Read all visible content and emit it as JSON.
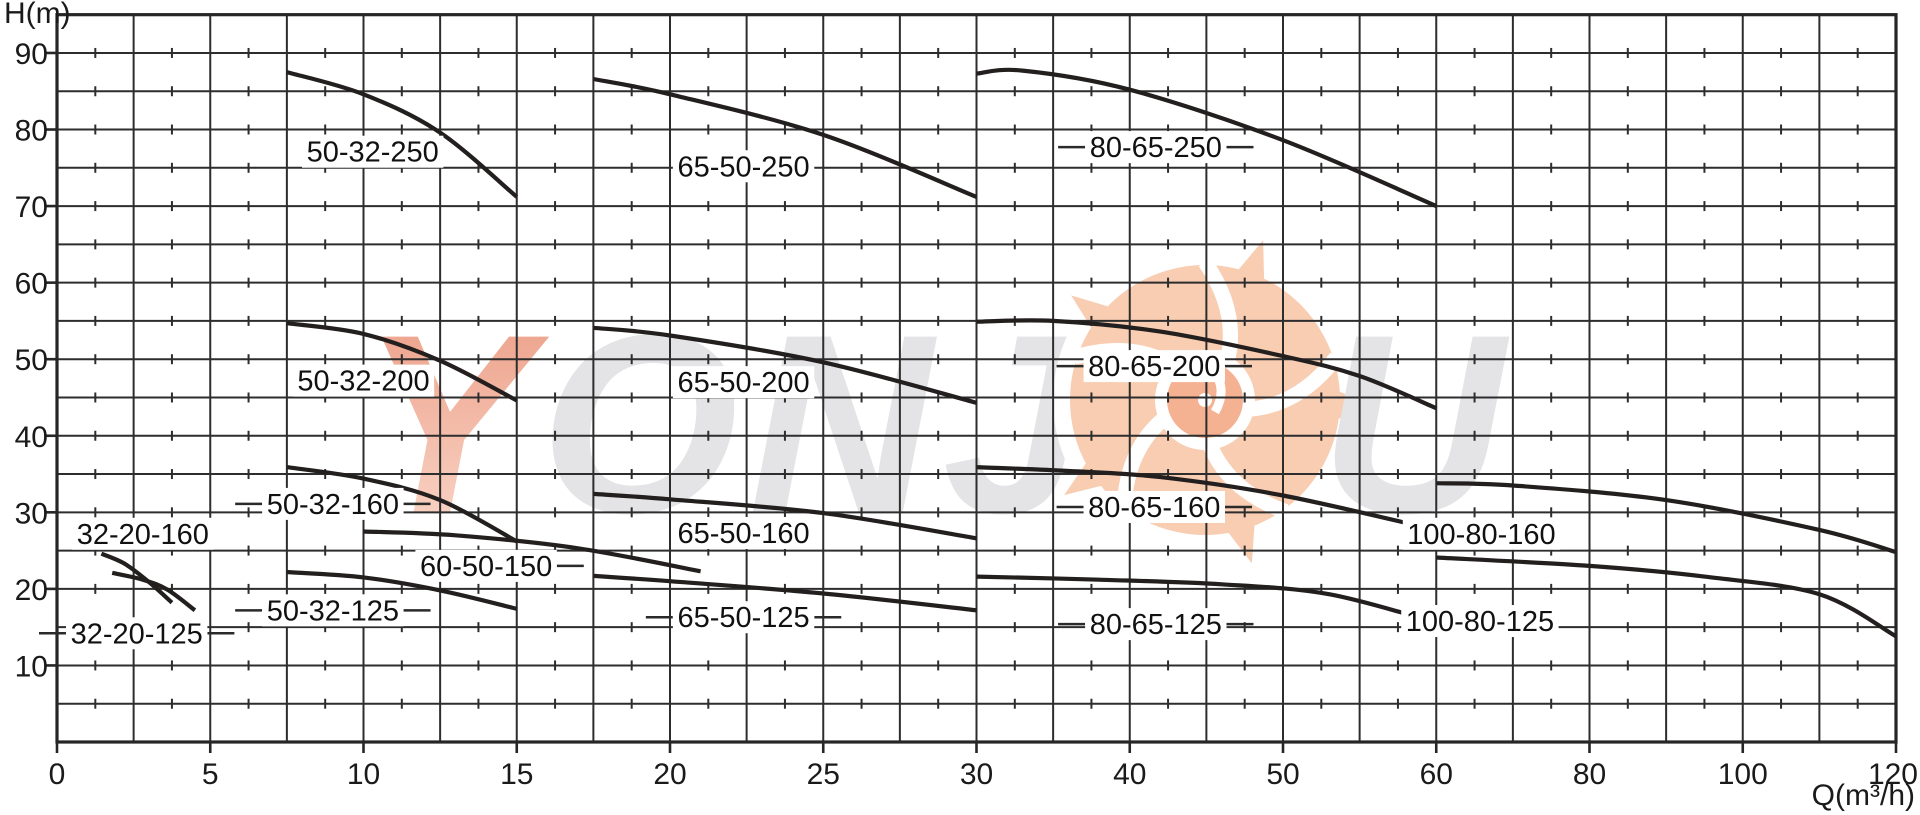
{
  "axes": {
    "y_title": "H(m)",
    "x_title": "Q(m³/h)"
  },
  "watermark": {
    "text_left": "YONJ",
    "text_right": "OU",
    "letter_color": "#e4e4e6",
    "first_letter_top": "#eb9a82",
    "first_letter_bottom": "#fbdccf",
    "flower_petal": "#f8cdb2",
    "flower_inner": "#f5b293"
  },
  "chart_data": {
    "type": "line",
    "title": "",
    "xlabel": "Q(m³/h)",
    "ylabel": "H(m)",
    "x_ticks": [
      0,
      5,
      10,
      15,
      20,
      25,
      30,
      40,
      50,
      60,
      80,
      100,
      120
    ],
    "y_tick_labels": [
      10,
      20,
      30,
      40,
      50,
      60,
      70,
      80,
      90
    ],
    "y_min": 0,
    "y_max": 95,
    "y_grid_step": 5,
    "grid": true,
    "grid_color": "#2d2d2d",
    "curve_color": "#241f1f",
    "label_text_color": "#111111",
    "series": [
      {
        "name": "32-20-160",
        "points": [
          [
            1.45,
            24.6
          ],
          [
            2.2,
            23.3
          ],
          [
            3.0,
            20.9
          ],
          [
            3.75,
            18.2
          ]
        ],
        "label_q": 2.8,
        "label_h": 27.2,
        "leaders": "none"
      },
      {
        "name": "32-20-125",
        "points": [
          [
            1.8,
            22.1
          ],
          [
            2.8,
            21.2
          ],
          [
            3.6,
            19.9
          ],
          [
            4.5,
            17.2
          ]
        ],
        "label_q": 2.6,
        "label_h": 14.2,
        "leaders": "both"
      },
      {
        "name": "50-32-250",
        "points": [
          [
            7.5,
            87.5
          ],
          [
            10,
            84.6
          ],
          [
            12.5,
            79.6
          ],
          [
            15,
            71.2
          ]
        ],
        "label_q": 10.3,
        "label_h": 77.1,
        "leaders": "none"
      },
      {
        "name": "50-32-200",
        "points": [
          [
            7.5,
            54.7
          ],
          [
            10,
            53.3
          ],
          [
            12.5,
            49.8
          ],
          [
            15,
            44.6
          ]
        ],
        "label_q": 10.0,
        "label_h": 47.2,
        "leaders": "none"
      },
      {
        "name": "50-32-160",
        "points": [
          [
            7.5,
            35.9
          ],
          [
            10,
            34.4
          ],
          [
            12.5,
            31.6
          ],
          [
            15,
            26.2
          ]
        ],
        "label_q": 9.0,
        "label_h": 31.1,
        "leaders": "both"
      },
      {
        "name": "50-32-125",
        "points": [
          [
            7.5,
            22.2
          ],
          [
            10,
            21.5
          ],
          [
            12.5,
            19.8
          ],
          [
            15,
            17.4
          ]
        ],
        "label_q": 9.0,
        "label_h": 17.2,
        "leaders": "both"
      },
      {
        "name": "60-50-150",
        "points": [
          [
            10,
            27.5
          ],
          [
            13,
            27.0
          ],
          [
            17,
            25.3
          ],
          [
            21,
            22.3
          ]
        ],
        "label_q": 14.0,
        "label_h": 23.0,
        "leaders": "right"
      },
      {
        "name": "65-50-250",
        "points": [
          [
            17.5,
            86.6
          ],
          [
            20,
            84.6
          ],
          [
            25,
            79.3
          ],
          [
            30,
            71.2
          ]
        ],
        "label_q": 22.4,
        "label_h": 75.2,
        "leaders": "none"
      },
      {
        "name": "65-50-200",
        "points": [
          [
            17.5,
            54.1
          ],
          [
            20,
            53.1
          ],
          [
            25,
            49.6
          ],
          [
            30,
            44.3
          ]
        ],
        "label_q": 22.4,
        "label_h": 47.0,
        "leaders": "none"
      },
      {
        "name": "65-50-160",
        "points": [
          [
            17.5,
            32.4
          ],
          [
            20,
            31.7
          ],
          [
            25,
            29.9
          ],
          [
            30,
            26.6
          ]
        ],
        "label_q": 22.4,
        "label_h": 27.3,
        "leaders": "none"
      },
      {
        "name": "65-50-125",
        "points": [
          [
            17.5,
            21.7
          ],
          [
            20,
            21.0
          ],
          [
            25,
            19.4
          ],
          [
            30,
            17.2
          ]
        ],
        "label_q": 22.4,
        "label_h": 16.3,
        "leaders": "both"
      },
      {
        "name": "80-65-250",
        "points": [
          [
            30,
            87.3
          ],
          [
            33,
            87.7
          ],
          [
            40,
            85.2
          ],
          [
            50,
            78.6
          ],
          [
            60,
            70.0
          ]
        ],
        "label_q": 41.7,
        "label_h": 77.7,
        "leaders": "both"
      },
      {
        "name": "80-65-200",
        "points": [
          [
            30,
            54.9
          ],
          [
            35,
            55.0
          ],
          [
            42,
            53.6
          ],
          [
            50,
            50.4
          ],
          [
            55,
            47.8
          ],
          [
            60,
            43.6
          ]
        ],
        "label_q": 41.6,
        "label_h": 49.1,
        "leaders": "both"
      },
      {
        "name": "80-65-160",
        "points": [
          [
            30,
            35.9
          ],
          [
            36,
            35.4
          ],
          [
            42,
            34.6
          ],
          [
            50,
            32.2
          ],
          [
            60,
            27.7
          ]
        ],
        "label_q": 41.6,
        "label_h": 30.7,
        "leaders": "both"
      },
      {
        "name": "80-65-125",
        "points": [
          [
            30,
            21.6
          ],
          [
            38,
            21.2
          ],
          [
            46,
            20.6
          ],
          [
            53,
            19.3
          ],
          [
            60,
            15.6
          ]
        ],
        "label_q": 41.7,
        "label_h": 15.4,
        "leaders": "both"
      },
      {
        "name": "100-80-160",
        "points": [
          [
            60,
            33.8
          ],
          [
            70,
            33.5
          ],
          [
            90,
            31.6
          ],
          [
            110,
            27.7
          ],
          [
            120,
            24.8
          ]
        ],
        "label_q": 65.9,
        "label_h": 27.2,
        "leaders": "none"
      },
      {
        "name": "100-80-125",
        "points": [
          [
            60,
            24.1
          ],
          [
            80,
            23.0
          ],
          [
            95,
            21.6
          ],
          [
            110,
            19.3
          ],
          [
            120,
            13.8
          ]
        ],
        "label_q": 65.7,
        "label_h": 15.8,
        "leaders": "none"
      }
    ]
  }
}
